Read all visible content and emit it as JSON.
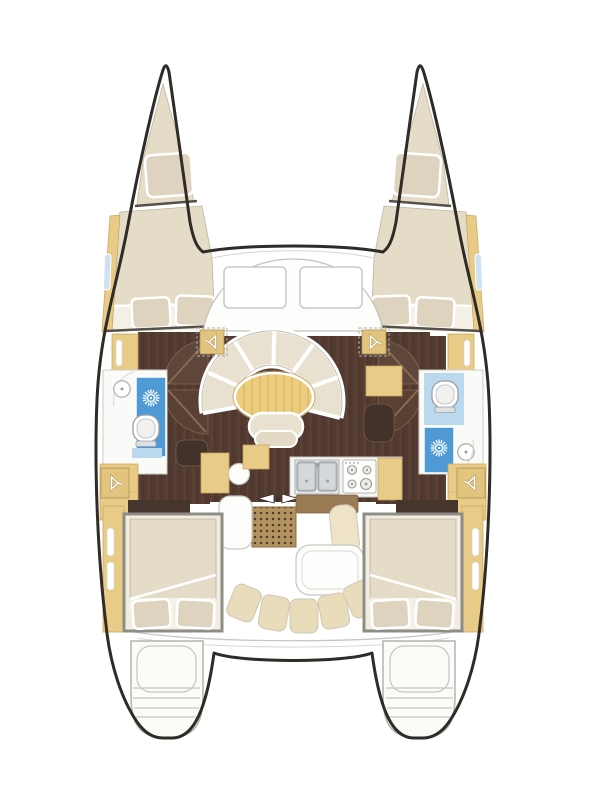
{
  "diagram": {
    "type": "boat-floor-plan",
    "subject": "sailing-catamaran-deck-plan",
    "view": "top-down-bow-up",
    "hull_count": 2,
    "areas": [
      "foredeck",
      "port-forepeak-berth",
      "starboard-forepeak-berth",
      "port-forward-cabin",
      "starboard-forward-cabin",
      "port-head-with-shower",
      "starboard-head-with-shower",
      "saloon-with-curved-settee",
      "galley-aft",
      "companionway",
      "cockpit",
      "port-aft-cabin",
      "starboard-aft-cabin",
      "port-sugar-scoop-steps",
      "starboard-sugar-scoop-steps"
    ],
    "fixtures": [
      "double-berths-with-two-pillows",
      "forepeak-single-pillows",
      "curved-settee-six-segments",
      "oval-saloon-table",
      "ottoman",
      "double-galley-sink",
      "four-burner-stove",
      "two-toilets",
      "two-shower-drains",
      "four-hanging-lockers",
      "companionway-step-mat",
      "sliding-door-arrows",
      "cockpit-table",
      "cockpit-bench-five-cushions",
      "two-coachroof-windows",
      "hull-window-slits",
      "stern-boarding-steps"
    ],
    "counts": {
      "settee_segments": 6,
      "bench_cushions": 5,
      "stove_burners": 4,
      "coachroof_windows": 2,
      "aft_cabin_pillows_each": 2,
      "forward_cabin_pillows_each": 2
    }
  },
  "icons": {
    "shower-drain": "sunburst",
    "hanging-locker": "clothes-hanger",
    "sliding-door": "opposing-arrows",
    "sink": "circle-basin"
  },
  "palette": {
    "hullStroke": "#2f2b26",
    "cream": "#e9e1d0",
    "bedCream": "#e5dcc7",
    "pillow": "#ddd3bf",
    "tan": "#e8cb86",
    "tanDark": "#c9a55f",
    "tableTan": "#eccd80",
    "floor": "#523a30",
    "floorGrain": "#63493b",
    "darkBrown": "#46352c",
    "brownStep": "#9b7b55",
    "matTan": "#b2925f",
    "matDot": "#503c28",
    "blue": "#4f9ad4",
    "paleBlue": "#bad8ee",
    "slitBlue": "#cfe2f1",
    "grayLine": "#c7c7c1",
    "benchTan": "#e9dcba"
  }
}
